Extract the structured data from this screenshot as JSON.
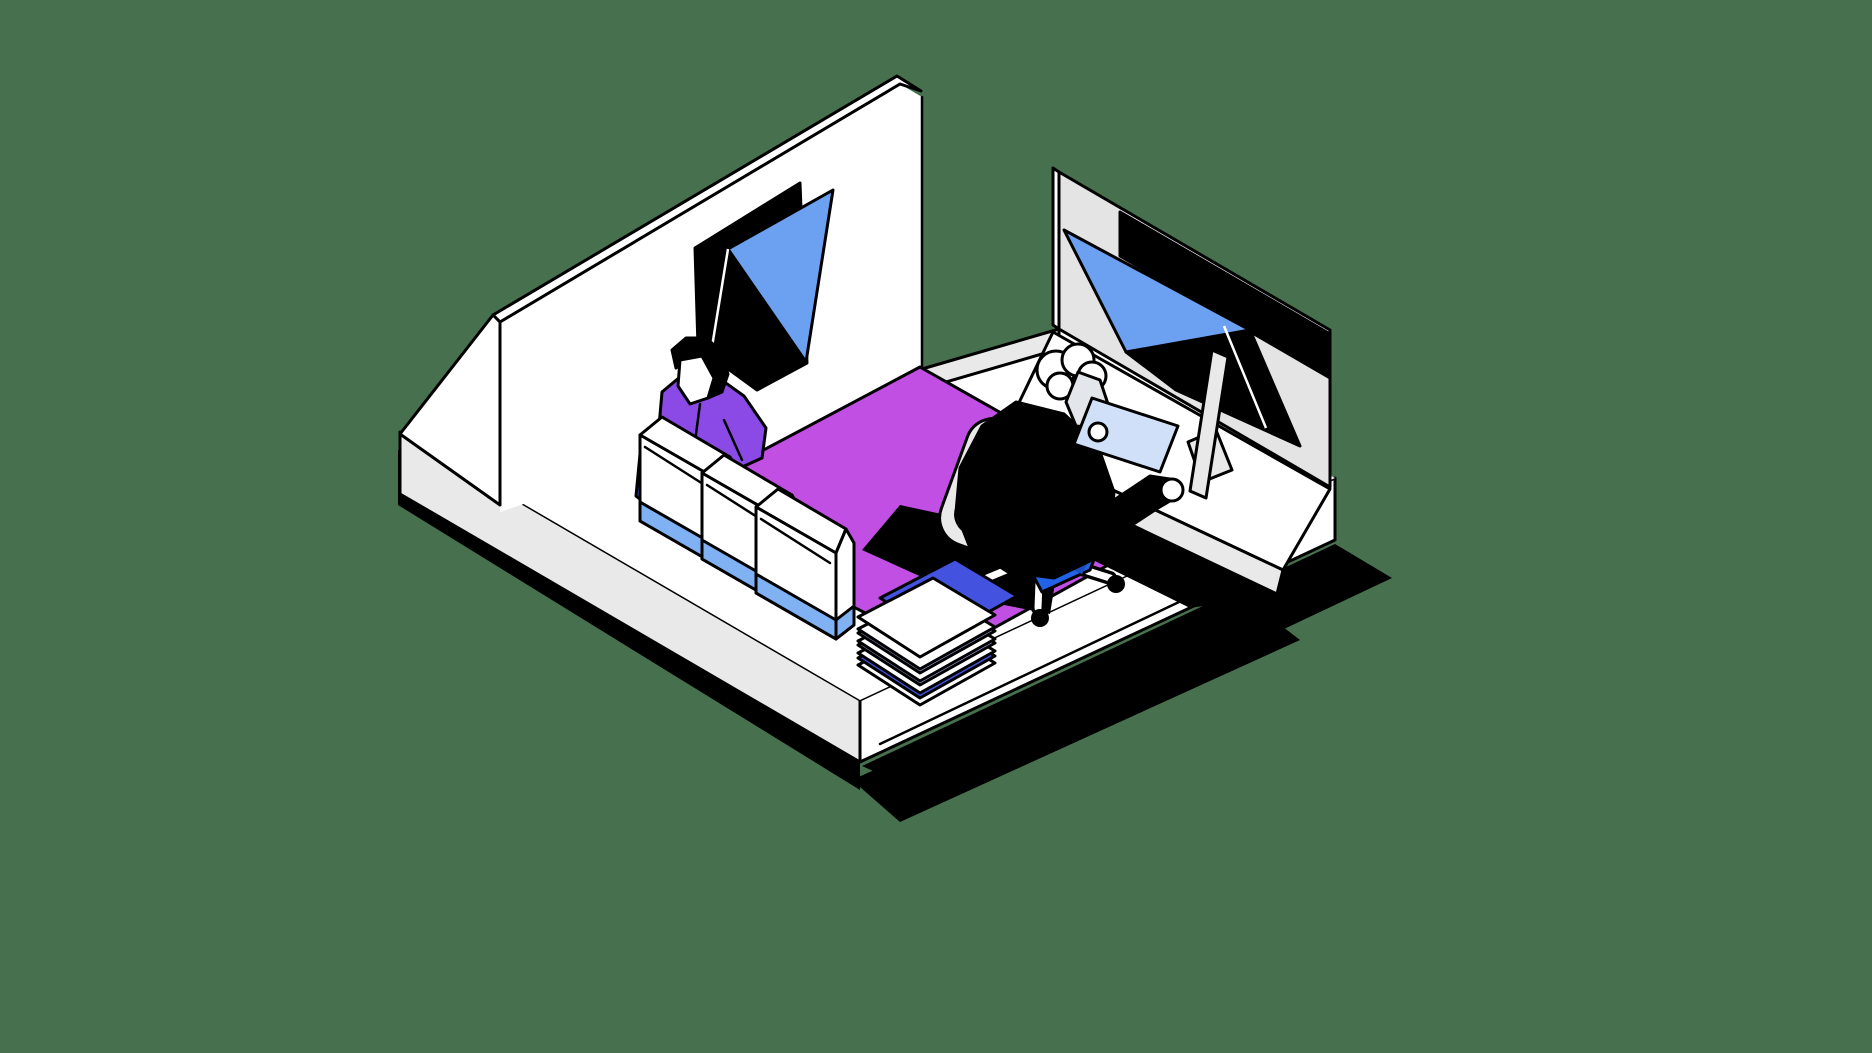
{
  "meta": {
    "title": "Isometric office illustration",
    "canvas_width": "1872",
    "canvas_height": "1053",
    "description": "Flat isometric vector illustration of a cutaway office room on a floating white plinth: one person standing behind white paper bags, one person seated on an office chair at a desk with a monitor, magenta carpet, abstract black-and-blue window art on both walls, solid green background."
  },
  "colors": {
    "background": "#47714E",
    "outline": "#000000",
    "white": "#FFFFFF",
    "light_gray": "#E9E9E9",
    "wall_right_gray": "#E4E4E4",
    "window_blue": "#6CA0F0",
    "bag_band_blue": "#7FB1F3",
    "royal_blue": "#4353E0",
    "lavender": "#A9AFEC",
    "carpet_magenta": "#C24FE3",
    "sweater_purple": "#8B49E6",
    "pants_blue": "#2262E6",
    "pants_blue_dark": "#1D50C0",
    "paper_blue": "#CFE0F8",
    "skin_light": "#E3E6EA",
    "shadow_black": "#000000"
  },
  "scene": {
    "objects": [
      "green-background",
      "ground-shadows",
      "white-plinth-base",
      "left-wall-with-window-art",
      "right-wall-with-window-art",
      "magenta-carpet",
      "standing-person-purple-sweater",
      "blue-pouch",
      "three-white-paper-bags",
      "stack-of-papers",
      "desk-with-monitor",
      "office-chair",
      "seated-person-black-sweater-blue-pants",
      "light-blue-document"
    ]
  }
}
